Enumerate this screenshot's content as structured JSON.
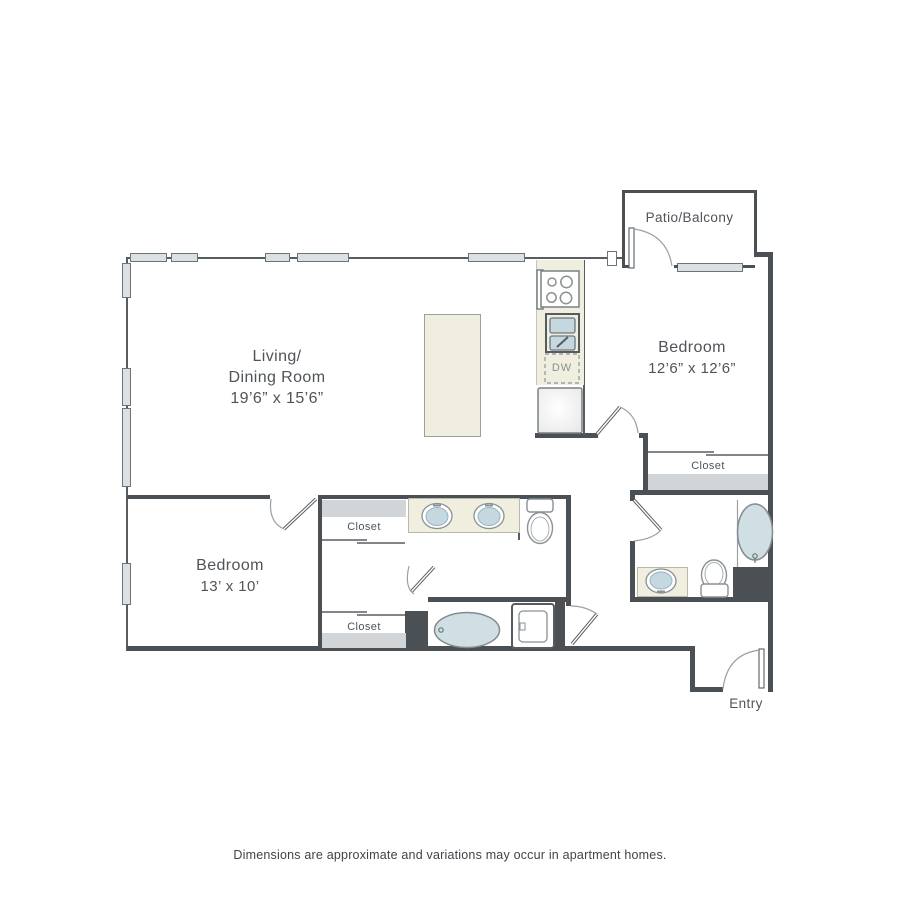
{
  "floor_plan": {
    "living_room": {
      "line1": "Living/",
      "line2": "Dining Room",
      "dims": "19’6” x 15’6”"
    },
    "bedroom_right": {
      "name": "Bedroom",
      "dims": "12’6” x 12’6”"
    },
    "bedroom_left": {
      "name": "Bedroom",
      "dims": "13’ x 10’"
    },
    "patio": {
      "label": "Patio/Balcony"
    },
    "entry": {
      "label": "Entry"
    },
    "closets": {
      "hall_upper": "Closet",
      "hall_lower": "Closet",
      "bedroom_right": "Closet"
    },
    "appliances": {
      "dishwasher_label": "DW"
    },
    "colors": {
      "wall": "#4b5055",
      "window": "#dbe0e2",
      "counter": "#f0efdf",
      "fixture_water": "#c5d8e0",
      "shelf": "#d2d5d7",
      "text": "#53585d"
    }
  },
  "footer": {
    "disclaimer": "Dimensions are approximate and variations may occur in apartment homes."
  }
}
